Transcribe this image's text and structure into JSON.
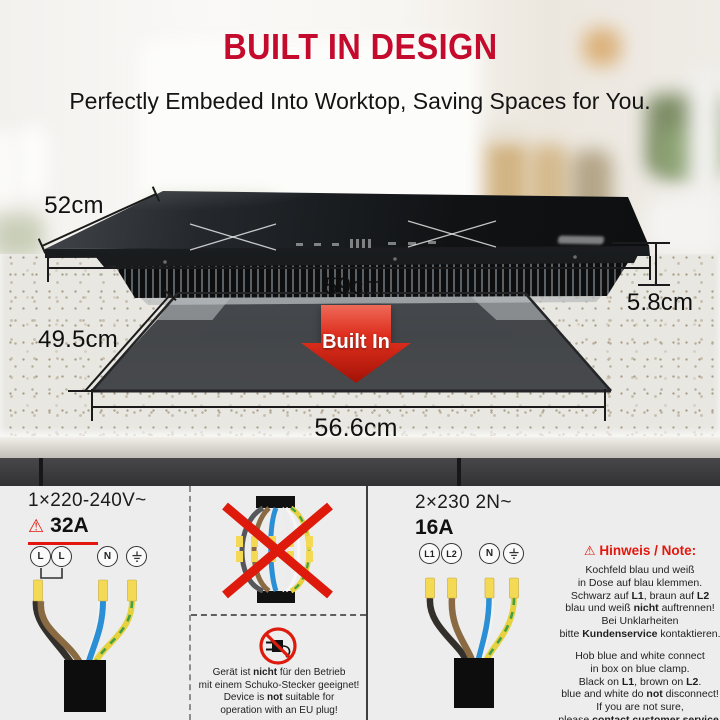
{
  "header": {
    "title": "BUILT IN DESIGN",
    "subtitle": "Perfectly Embeded Into Worktop, Saving Spaces for You."
  },
  "hero": {
    "built_in_label": "Built In",
    "dimensions": {
      "hob_depth": "52cm",
      "hob_width": "59cm",
      "hob_height": "5.8cm",
      "cutout_depth": "49.5cm",
      "cutout_width": "56.6cm"
    }
  },
  "icons": {
    "warning": "⚠"
  },
  "wiring": {
    "single_phase": {
      "voltage": "1×220-240V~",
      "amperage": "32A",
      "terminals": [
        "L",
        "L",
        "N",
        "⏚"
      ]
    },
    "two_phase": {
      "voltage": "2×230 2N~",
      "amperage": "16A",
      "terminals": [
        "L1",
        "L2",
        "N",
        "⏚"
      ]
    },
    "plug_warning": [
      [
        "Gerät ist ",
        [
          "nicht",
          true
        ],
        " für den Betrieb"
      ],
      [
        "mit einem Schuko-Stecker geeignet!"
      ],
      [
        "Device is ",
        [
          "not",
          true
        ],
        " suitable for"
      ],
      [
        "operation with an EU plug!"
      ]
    ],
    "note": {
      "heading": "Hinweis / Note:",
      "german": [
        [
          "Kochfeld blau und weiß"
        ],
        [
          "in Dose auf blau klemmen."
        ],
        [
          "Schwarz auf ",
          [
            "L1",
            true
          ],
          ", braun auf ",
          [
            "L2",
            true
          ]
        ],
        [
          "blau und weiß ",
          [
            "nicht",
            true
          ],
          " auftrennen!"
        ],
        [
          "Bei Unklarheiten"
        ],
        [
          "bitte ",
          [
            "Kundenservice",
            true
          ],
          " kontaktieren."
        ]
      ],
      "english": [
        [
          "Hob blue and white connect"
        ],
        [
          "in box on blue clamp."
        ],
        [
          "Black on ",
          [
            "L1",
            true
          ],
          ", brown on ",
          [
            "L2",
            true
          ],
          "."
        ],
        [
          "blue and white do ",
          [
            "not",
            true
          ],
          " disconnect!"
        ],
        [
          "If you are not sure,"
        ],
        [
          "please ",
          [
            "contact customer service",
            true
          ],
          "."
        ]
      ]
    }
  }
}
